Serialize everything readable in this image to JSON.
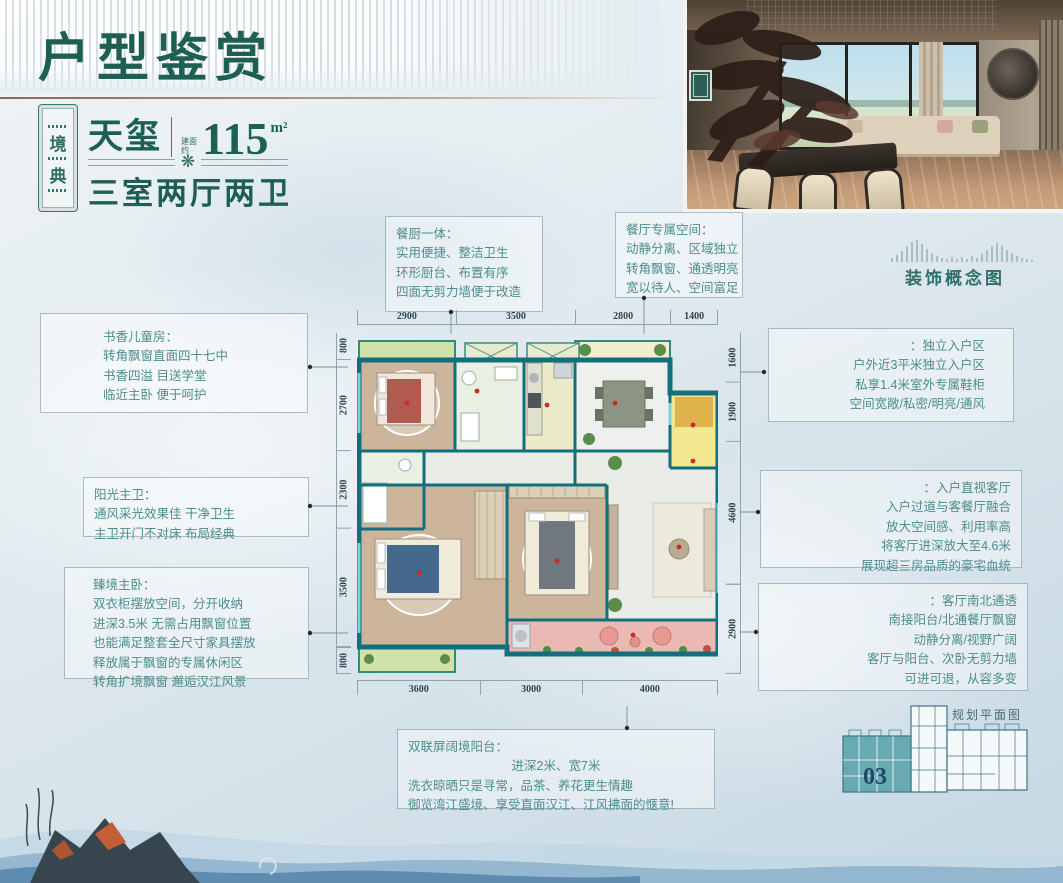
{
  "colors": {
    "accent_green": "#1e5f53",
    "callout_teal": "#4d8c8c",
    "wall_teal": "#136f7d",
    "entry_yellow": "#f2e88f",
    "balcony_pink": "#eab9b3",
    "unit_fill": "#68aab2"
  },
  "header": {
    "title": "户型鉴赏",
    "seal_chars": [
      "境",
      "典"
    ],
    "product_name": "天玺",
    "area_label": "建面约",
    "area_value": "115",
    "area_unit": "m²",
    "layout": "三室两厅两卫",
    "flower_icon": "❋"
  },
  "concept_caption": "装饰概念图",
  "callouts": {
    "kitchen": {
      "title": "餐厨一体：",
      "lines": [
        "实用便捷、整洁卫生",
        "环形厨台、布置有序",
        "四面无剪力墙便于改造"
      ]
    },
    "dining": {
      "title": "餐厅专属空间：",
      "lines": [
        "动静分离、区域独立",
        "转角飘窗、通透明亮",
        "宽以待人、空间富足"
      ]
    },
    "kids_room": {
      "title": "书香儿童房：",
      "lines": [
        "转角飘窗直面四十七中",
        "书香四溢 目送学堂",
        "临近主卧 便于呵护"
      ]
    },
    "master_bath": {
      "title": "阳光主卫：",
      "lines": [
        "通风采光效果佳 干净卫生",
        "主卫开门不对床 布局经典"
      ]
    },
    "master_bed": {
      "title": "臻境主卧：",
      "lines": [
        "双衣柜摆放空间，分开收纳",
        "进深3.5米 无需占用飘窗位置",
        "也能满足整套全尺寸家具摆放",
        "释放属于飘窗的专属休闲区",
        "转角扩境飘窗 邂逅汉江风景"
      ]
    },
    "entry": {
      "title": "：独立入户区",
      "lines": [
        "户外近3平米独立入户区",
        "私享1.4米室外专属鞋柜",
        "空间宽敞/私密/明亮/通风"
      ]
    },
    "living_entry": {
      "title": "：入户直视客厅",
      "lines": [
        "入户过道与客餐厅融合",
        "放大空间感、利用率高",
        "将客厅进深放大至4.6米",
        "展现超三房品质的豪宅血统"
      ]
    },
    "living": {
      "title": "：客厅南北通透",
      "lines": [
        "南接阳台/北通餐厅飘窗",
        "动静分离/视野广阔",
        "客厅与阳台、次卧无剪力墙",
        "可进可退，从容多变"
      ]
    },
    "balcony": {
      "title": "双联屏阔境阳台：",
      "lines": [
        "进深2米、宽7米",
        "洗衣晾晒只是寻常，品茶、养花更生情趣",
        "御览湾江盛境、享受直面汉江、江风拂面的惬意!"
      ]
    }
  },
  "floorplan": {
    "dims_top": [
      "2900",
      "3500",
      "2800",
      "1400"
    ],
    "dims_left": [
      "800",
      "2700",
      "2300",
      "3500",
      "800"
    ],
    "dims_right": [
      "1600",
      "1900",
      "4600",
      "2900"
    ],
    "dims_bottom": [
      "3600",
      "3000",
      "4000"
    ]
  },
  "site_plan": {
    "unit_label": "03",
    "caption": "规划平面图"
  }
}
